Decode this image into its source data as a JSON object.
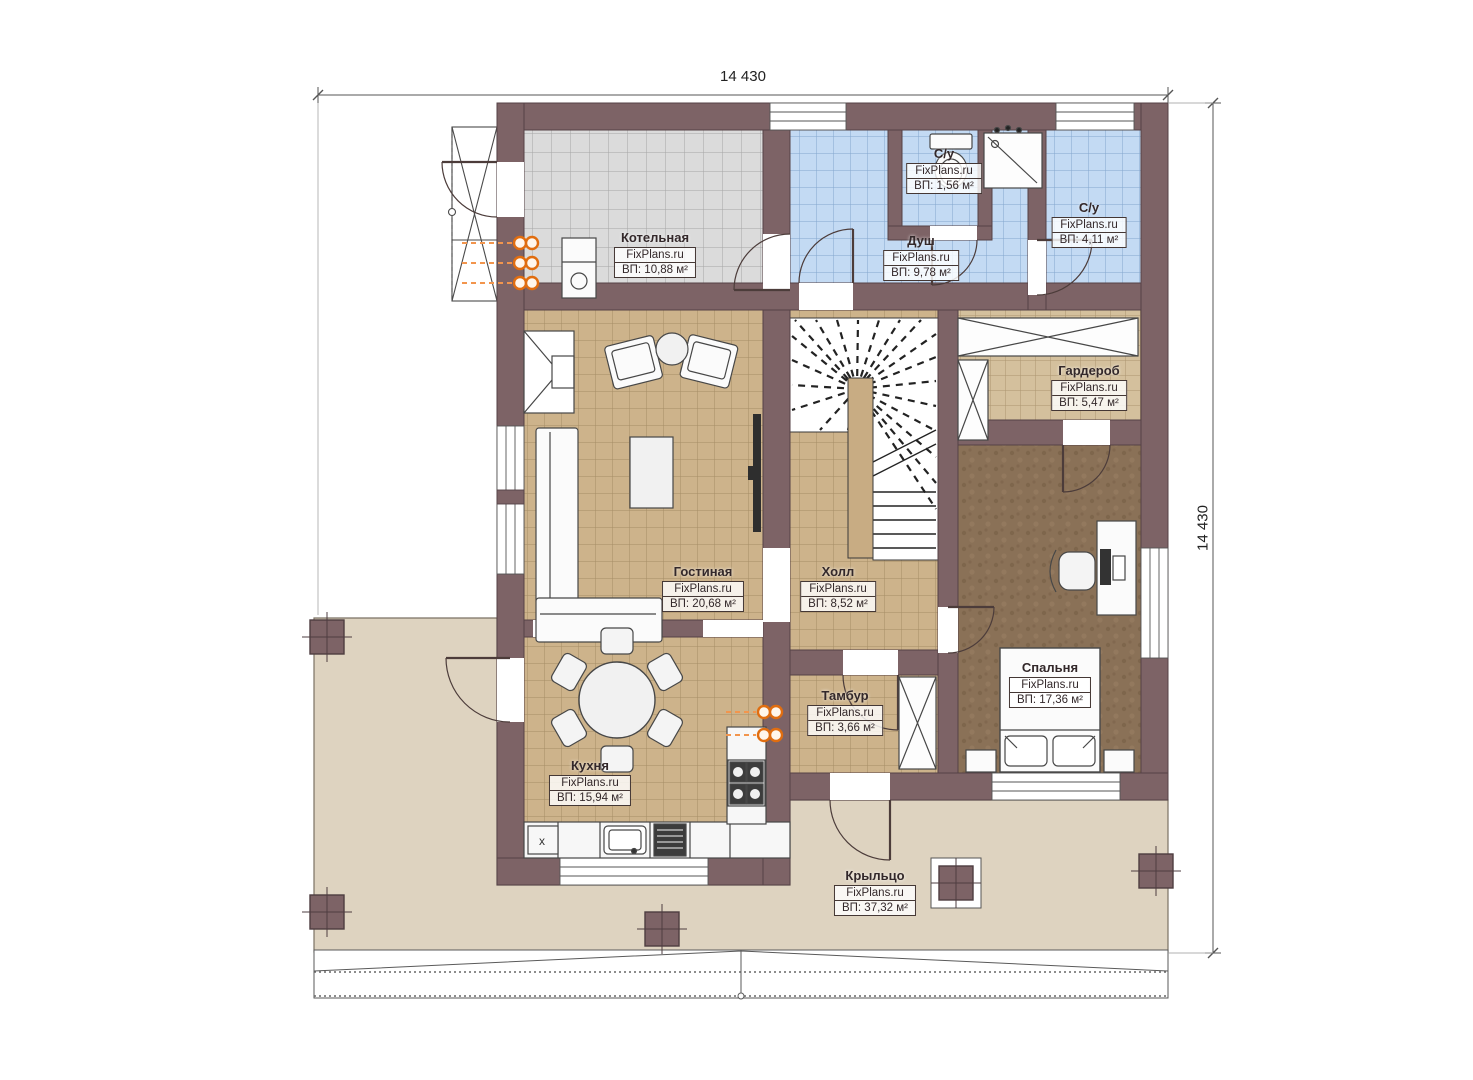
{
  "plan": {
    "brand": "FixPlans.ru",
    "dimensions": {
      "top": "14 430",
      "right": "14 430"
    },
    "annotations": {
      "cabinet_mark": "x"
    },
    "rooms": [
      {
        "id": "boiler",
        "name": "Котельная",
        "brand": "FixPlans.ru",
        "area": "ВП: 10,88 м²"
      },
      {
        "id": "wc-top",
        "name": "С/у",
        "brand": "FixPlans.ru",
        "area": "ВП: 1,56 м²"
      },
      {
        "id": "shower",
        "name": "Душ",
        "brand": "FixPlans.ru",
        "area": "ВП: 9,78 м²"
      },
      {
        "id": "wc-right",
        "name": "С/у",
        "brand": "FixPlans.ru",
        "area": "ВП: 4,11 м²"
      },
      {
        "id": "wardrobe",
        "name": "Гардероб",
        "brand": "FixPlans.ru",
        "area": "ВП: 5,47 м²"
      },
      {
        "id": "living",
        "name": "Гостиная",
        "brand": "FixPlans.ru",
        "area": "ВП: 20,68 м²"
      },
      {
        "id": "hall",
        "name": "Холл",
        "brand": "FixPlans.ru",
        "area": "ВП: 8,52 м²"
      },
      {
        "id": "bedroom",
        "name": "Спальня",
        "brand": "FixPlans.ru",
        "area": "ВП: 17,36 м²"
      },
      {
        "id": "tambour",
        "name": "Тамбур",
        "brand": "FixPlans.ru",
        "area": "ВП: 3,66 м²"
      },
      {
        "id": "kitchen",
        "name": "Кухня",
        "brand": "FixPlans.ru",
        "area": "ВП: 15,94 м²"
      },
      {
        "id": "porch",
        "name": "Крыльцо",
        "brand": "FixPlans.ru",
        "area": "ВП: 37,32 м²"
      }
    ],
    "colors": {
      "wall": "#7d6366",
      "tile_gray": "#dbdbdb",
      "tile_blue": "#c3daf3",
      "tile_tan": "#cdb38b",
      "carpet_brown": "#8a7157",
      "porch": "#ded3c0",
      "accent_orange": "#f08327"
    }
  }
}
